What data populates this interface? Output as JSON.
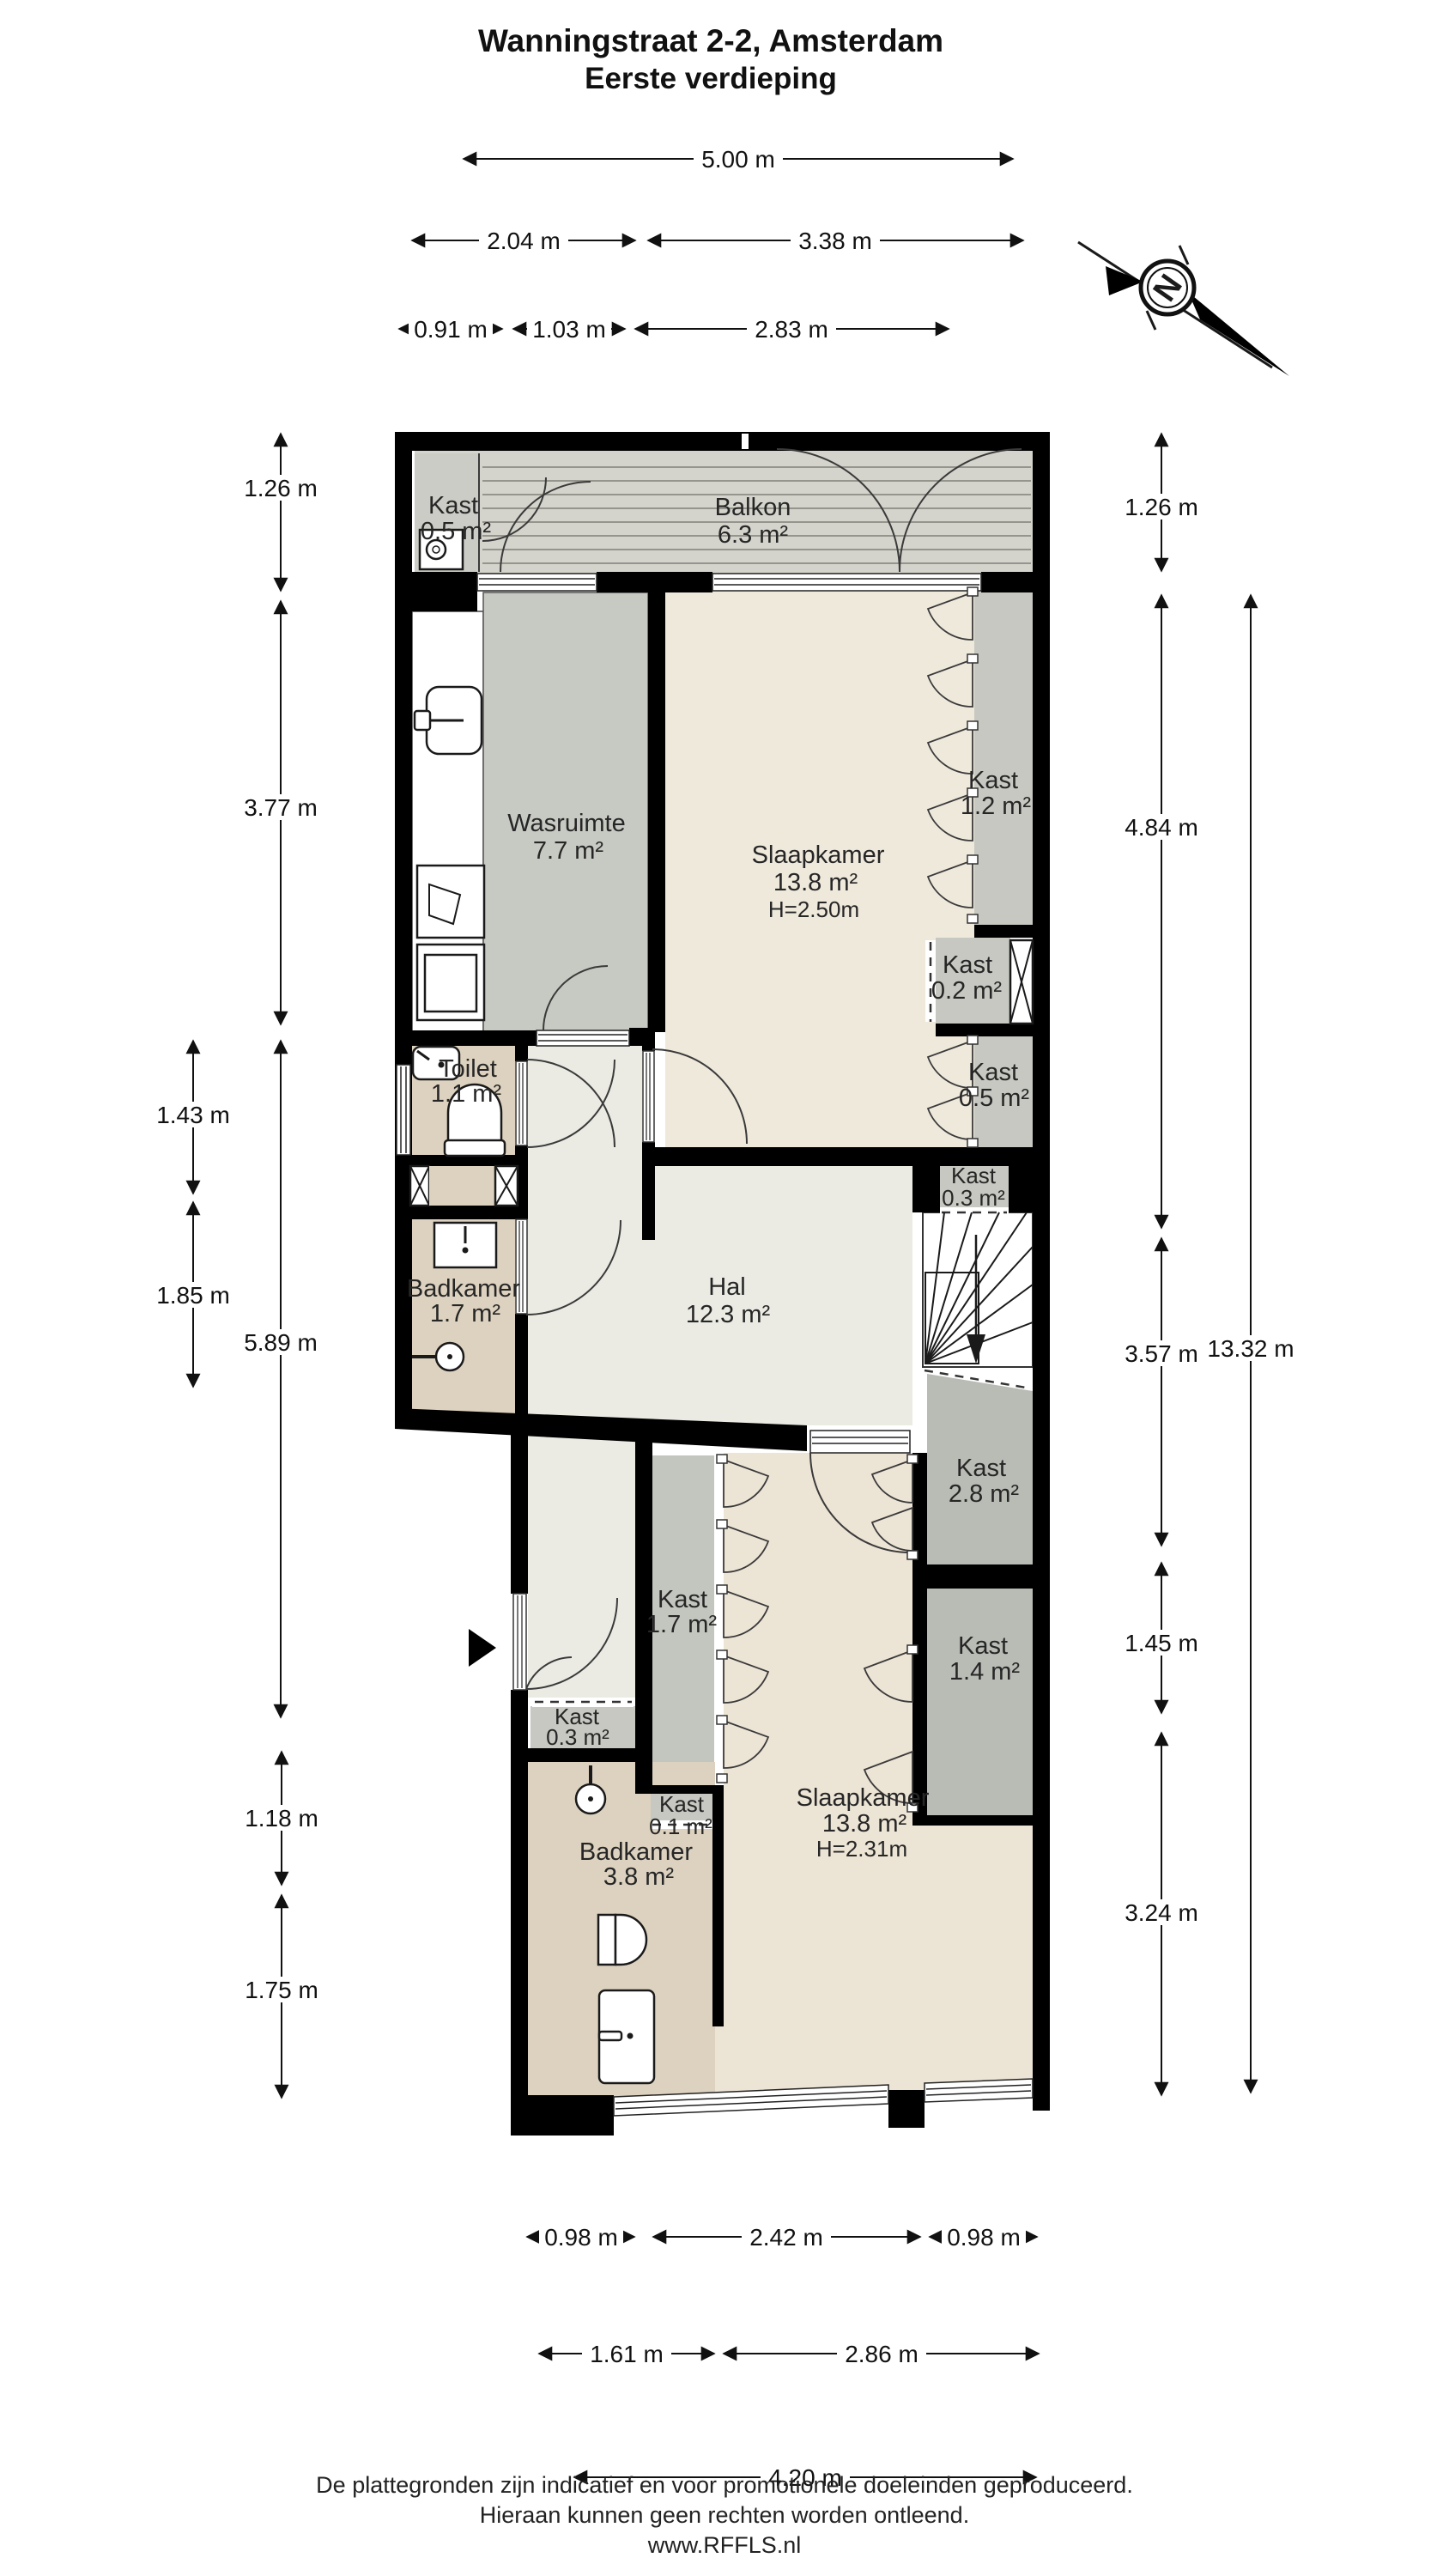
{
  "title": {
    "line1": "Wanningstraat 2-2, Amsterdam",
    "line2": "Eerste verdieping"
  },
  "compass": {
    "label": "N"
  },
  "dimensions": {
    "top": [
      "5.00 m",
      "2.04 m",
      "3.38 m",
      "0.91 m",
      "1.03 m",
      "2.83 m"
    ],
    "left": [
      "1.26 m",
      "3.77 m",
      "1.43 m",
      "1.85 m",
      "5.89 m",
      "1.18 m",
      "1.75 m"
    ],
    "right": [
      "1.26 m",
      "4.84 m",
      "3.57 m",
      "13.32 m",
      "1.45 m",
      "3.24 m"
    ],
    "bottom": [
      "0.98 m",
      "2.42 m",
      "0.98 m",
      "1.61 m",
      "2.86 m",
      "4.20 m"
    ]
  },
  "rooms": {
    "kast_balkon": {
      "name": "Kast",
      "area": "0.5 m²"
    },
    "balkon": {
      "name": "Balkon",
      "area": "6.3 m²"
    },
    "wasruimte": {
      "name": "Wasruimte",
      "area": "7.7 m²"
    },
    "slaapkamer_boven": {
      "name": "Slaapkamer",
      "area": "13.8 m²",
      "height": "H=2.50m"
    },
    "kast_1_2": {
      "name": "Kast",
      "area": "1.2 m²"
    },
    "kast_0_2": {
      "name": "Kast",
      "area": "0.2 m²"
    },
    "kast_0_5": {
      "name": "Kast",
      "area": "0.5 m²"
    },
    "kast_0_3_boven": {
      "name": "Kast",
      "area": "0.3 m²"
    },
    "toilet": {
      "name": "Toilet",
      "area": "1.1 m²"
    },
    "badkamer_boven": {
      "name": "Badkamer",
      "area": "1.7 m²"
    },
    "hal": {
      "name": "Hal",
      "area": "12.3 m²"
    },
    "kast_2_8": {
      "name": "Kast",
      "area": "2.8 m²"
    },
    "kast_1_7": {
      "name": "Kast",
      "area": "1.7 m²"
    },
    "kast_1_4": {
      "name": "Kast",
      "area": "1.4 m²"
    },
    "kast_0_3_onder": {
      "name": "Kast",
      "area": "0.3 m²"
    },
    "kast_0_1": {
      "name": "Kast",
      "area": "0.1 m²"
    },
    "badkamer_onder": {
      "name": "Badkamer",
      "area": "3.8 m²"
    },
    "slaapkamer_onder": {
      "name": "Slaapkamer",
      "area": "13.8 m²",
      "height": "H=2.31m"
    }
  },
  "footer": {
    "line1": "De plattegronden zijn indicatief en voor promotionele doeleinden geproduceerd.",
    "line2": "Hieraan kunnen geen rechten worden ontleend.",
    "line3": "www.RFFLS.nl"
  },
  "colors": {
    "wall": "#000000",
    "bedroom_light": "#efe9dc",
    "bedroom_warm": "#ece4d5",
    "hall": "#ebebe4",
    "closet_gray": "#c6c8c1",
    "closet_dark": "#b9bcb5",
    "laundry": "#c7cac2",
    "bathroom_tan": "#ddd2bf",
    "balcony": "#d4d4cc",
    "balcony_stripe": "#90908a"
  }
}
